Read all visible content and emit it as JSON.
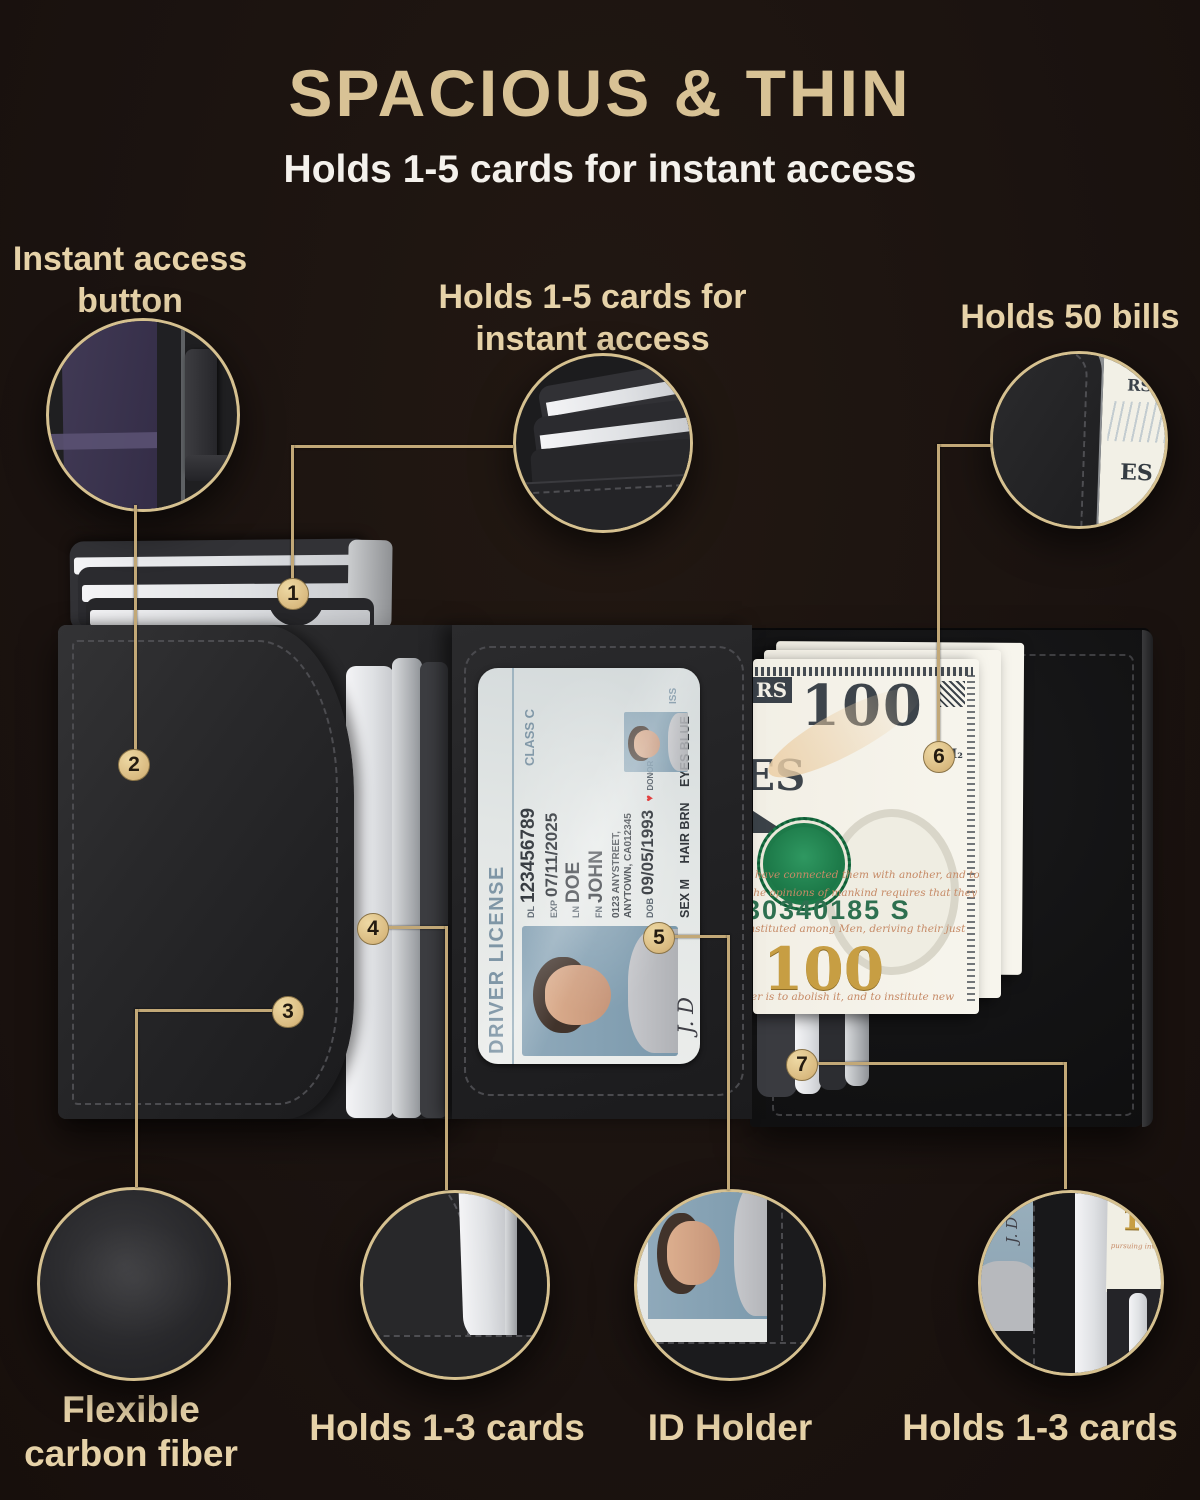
{
  "header": {
    "title": "SPACIOUS & THIN",
    "subtitle": "Holds 1-5 cards for instant access"
  },
  "callout_labels": {
    "instant_access_line1": "Instant access",
    "instant_access_line2": "button",
    "holds15_line1": "Holds 1-5 cards for",
    "holds15_line2": "instant access",
    "holds50": "Holds 50 bills",
    "carbon_line1": "Flexible",
    "carbon_line2": "carbon fiber",
    "holds13_left": "Holds 1-3 cards",
    "id_holder": "ID Holder",
    "holds13_right": "Holds 1-3 cards"
  },
  "callout_numbers": [
    "1",
    "2",
    "3",
    "4",
    "5",
    "6",
    "7"
  ],
  "license": {
    "header": "DRIVER LICENSE",
    "class_c": "CLASS C",
    "dl_label": "DL",
    "dl": "123456789",
    "exp_label": "EXP",
    "exp": "07/11/2025",
    "ln_label": "LN",
    "ln": "DOE",
    "fn_label": "FN",
    "fn": "JOHN",
    "address1": "0123 ANYSTREET,",
    "address2": "ANYTOWN, CA012345",
    "dob_label": "DOB",
    "dob": "09/05/1993",
    "heart": "♥",
    "donor": "DONOR",
    "sex": "SEX M",
    "hair": "HAIR BRN",
    "eyes": "EYES BLUE",
    "iss": "ISS",
    "signature": "J. D"
  },
  "bill": {
    "denomination": "100",
    "h2": "H₂",
    "serial": "30340185 S",
    "fragment_rs": "RS",
    "fragment_es": "ES",
    "script_lines": [
      "have connected them with another, and to",
      "the opinions of mankind requires that they",
      "instituted among Men, deriving their just",
      "er is to abolish it, and to institute new",
      "pursuing invariably the same Object"
    ]
  },
  "colors": {
    "accent_gold": "#d8c295",
    "line_gold": "#c2a877",
    "badge_gold": "#d9ba80",
    "seal_green": "#1d7a49",
    "serial_green": "#2e7050",
    "bill_gold": "#c79e43"
  }
}
